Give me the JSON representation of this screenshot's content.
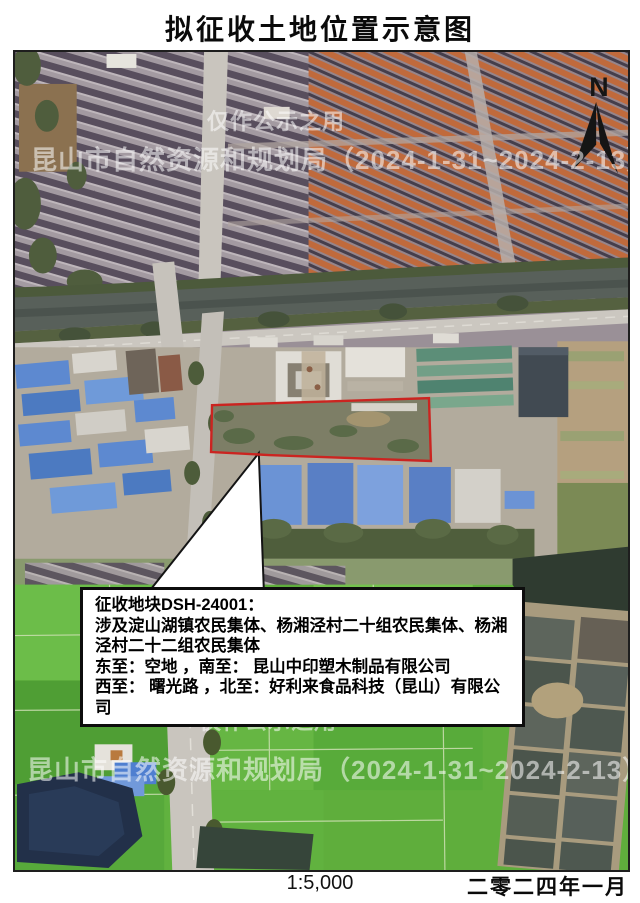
{
  "page": {
    "title": "拟征收土地位置示意图"
  },
  "map": {
    "north_label": "N",
    "watermark": {
      "line1": "仅作公示之用",
      "line2": "昆山市自然资源和规划局（2024-1-31~2024-2-13）"
    },
    "callout": {
      "line1": "征收地块DSH-24001：",
      "line2a": "涉及淀山湖镇农民集体、杨湘泾村二十组农民集体、杨湘",
      "line2b": "泾村二十二组农民集体",
      "line3": "东至：空地 ，南至： 昆山中印塑木制品有限公司",
      "line4": "西至： 曙光路 ，北至：好利来食品科技（昆山）有限公司"
    },
    "colors": {
      "parcel_outline": "#cb2420"
    }
  },
  "footer": {
    "scale": "1:5,000",
    "date": "二零二四年一月"
  }
}
